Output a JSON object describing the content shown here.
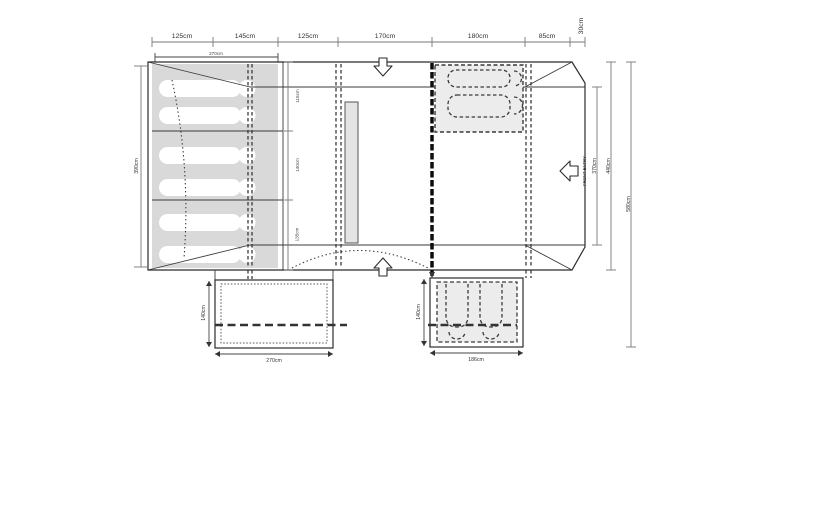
{
  "diagram": {
    "type": "tent-floorplan-top-view",
    "top_scale": {
      "labels": [
        "125cm",
        "145cm",
        "125cm",
        "170cm",
        "180cm",
        "85cm",
        "30cm"
      ]
    },
    "bedroom": {
      "width_label": "270cm",
      "height_label": "390cm",
      "section_labels": [
        "115cm",
        "140cm",
        "135cm"
      ],
      "sleeper_count": 6
    },
    "front": {
      "entry_label": "FRONT ENTRY",
      "opening_label": "370cm"
    },
    "depths": {
      "body_label": "440cm",
      "total_label": "580cm"
    },
    "left_annex": {
      "depth_label": "140cm",
      "width_label": "270cm",
      "sleeper_count": 2
    },
    "right_annex": {
      "depth_label": "140cm",
      "width_label": "186cm",
      "sleeper_count": 2
    },
    "colors": {
      "line": "#2b2b2b",
      "dim_line": "#777777",
      "text": "#333333",
      "bedroom_fill": "#d9d9d9",
      "panel_fill": "#ececec",
      "furniture_fill": "#e4e4e4"
    }
  }
}
